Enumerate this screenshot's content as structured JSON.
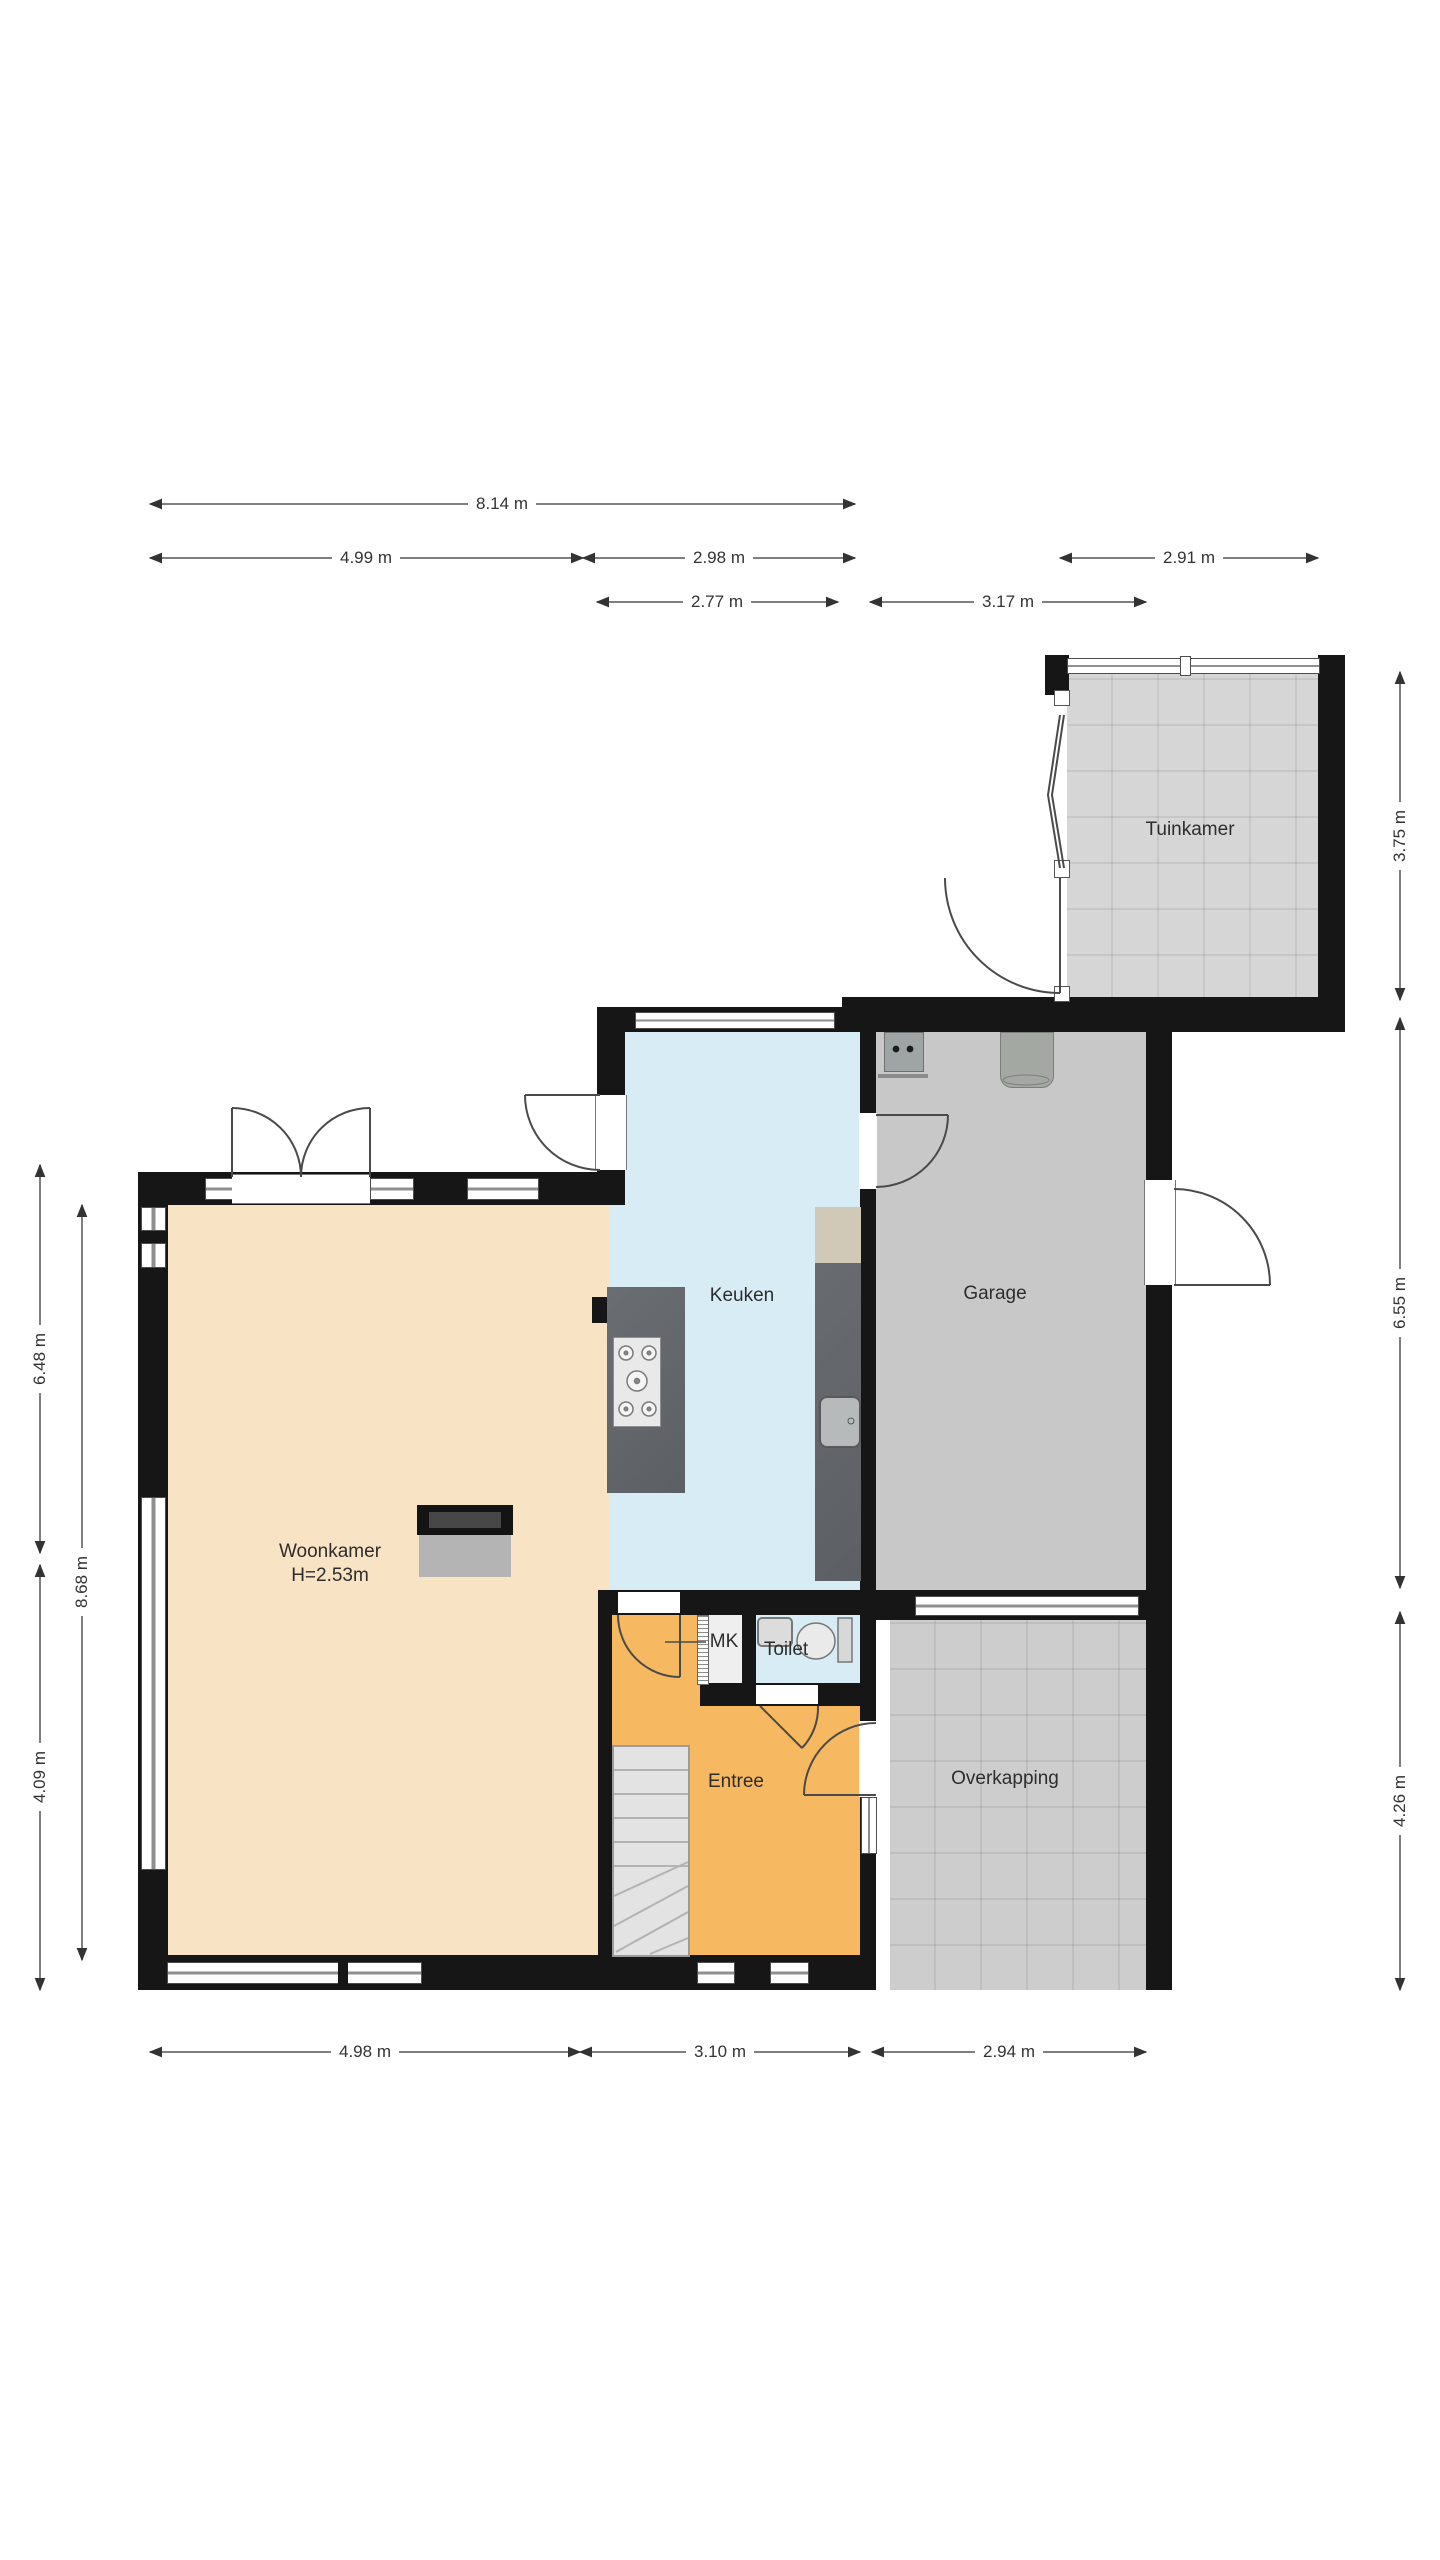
{
  "rooms": [
    {
      "label": "Woonkamer",
      "sub": "H=2.53m"
    },
    {
      "label": "Keuken"
    },
    {
      "label": "Garage"
    },
    {
      "label": "Tuinkamer"
    },
    {
      "label": "Toilet"
    },
    {
      "label": "MK"
    },
    {
      "label": "Entree"
    },
    {
      "label": "Overkapping"
    }
  ],
  "dimensions": [
    {
      "label": "8.14 m",
      "edge": "top"
    },
    {
      "label": "4.99 m",
      "edge": "top"
    },
    {
      "label": "2.98 m",
      "edge": "top"
    },
    {
      "label": "2.91 m",
      "edge": "top"
    },
    {
      "label": "2.77 m",
      "edge": "top"
    },
    {
      "label": "3.17 m",
      "edge": "top"
    },
    {
      "label": "3.75 m",
      "edge": "right"
    },
    {
      "label": "6.55 m",
      "edge": "right"
    },
    {
      "label": "4.26 m",
      "edge": "right"
    },
    {
      "label": "6.48 m",
      "edge": "left"
    },
    {
      "label": "8.68 m",
      "edge": "left"
    },
    {
      "label": "4.09 m",
      "edge": "left"
    },
    {
      "label": "4.98 m",
      "edge": "bottom"
    },
    {
      "label": "3.10 m",
      "edge": "bottom"
    },
    {
      "label": "2.94 m",
      "edge": "bottom"
    }
  ],
  "fixtures": [
    {
      "name": "fireplace"
    },
    {
      "name": "kitchen-island"
    },
    {
      "name": "gas-hob"
    },
    {
      "name": "kitchen-counter"
    },
    {
      "name": "sink"
    },
    {
      "name": "staircase"
    },
    {
      "name": "toilet-bowl"
    },
    {
      "name": "hand-basin"
    },
    {
      "name": "mk-louvre-door"
    },
    {
      "name": "cv-boiler"
    },
    {
      "name": "water-heater"
    }
  ],
  "colors": {
    "wall": "#161616",
    "woonkamer_floor": "#f8e3c5",
    "keuken_floor": "#d8ecf5",
    "toilet_floor": "#d8ecf5",
    "entree_floor": "#f6b961",
    "garage_floor": "#c8c8c8",
    "tuinkamer_floor": "#d6d6d6",
    "overkapping_floor": "#cdcdcd",
    "dimension_text": "#333333"
  }
}
